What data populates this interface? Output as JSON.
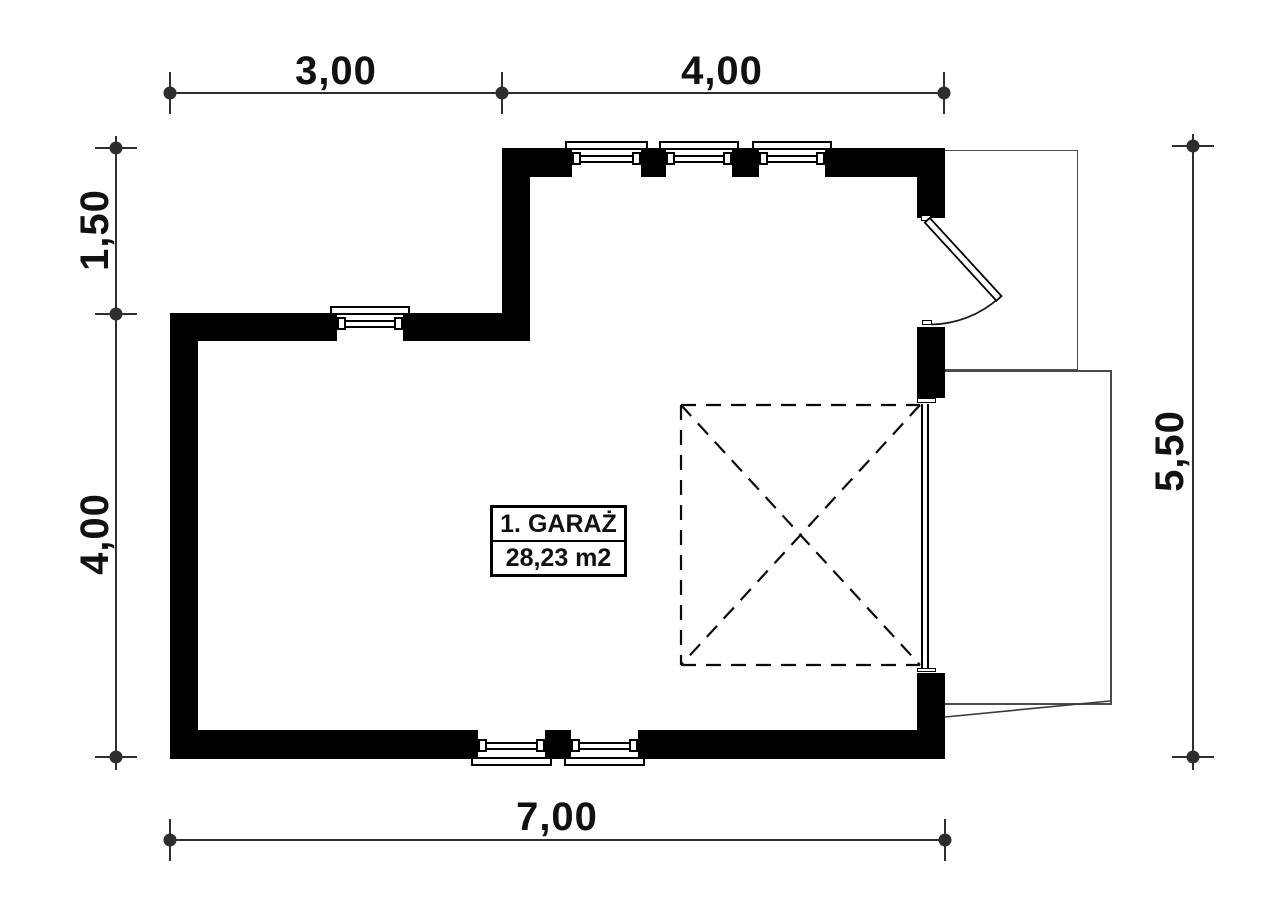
{
  "floor_plan": {
    "room": {
      "name": "1. GARAŻ",
      "area": "28,23 m2"
    },
    "dimensions": {
      "top_left_segment": "3,00",
      "top_right_segment": "4,00",
      "left_upper_segment": "1,50",
      "left_lower_segment": "4,00",
      "right_total": "5,50",
      "bottom_total": "7,00"
    },
    "colors": {
      "wall": "#000000",
      "line": "#2e2e2e",
      "outline": "#4a4a4a",
      "background": "#ffffff",
      "text": "#111111"
    }
  }
}
